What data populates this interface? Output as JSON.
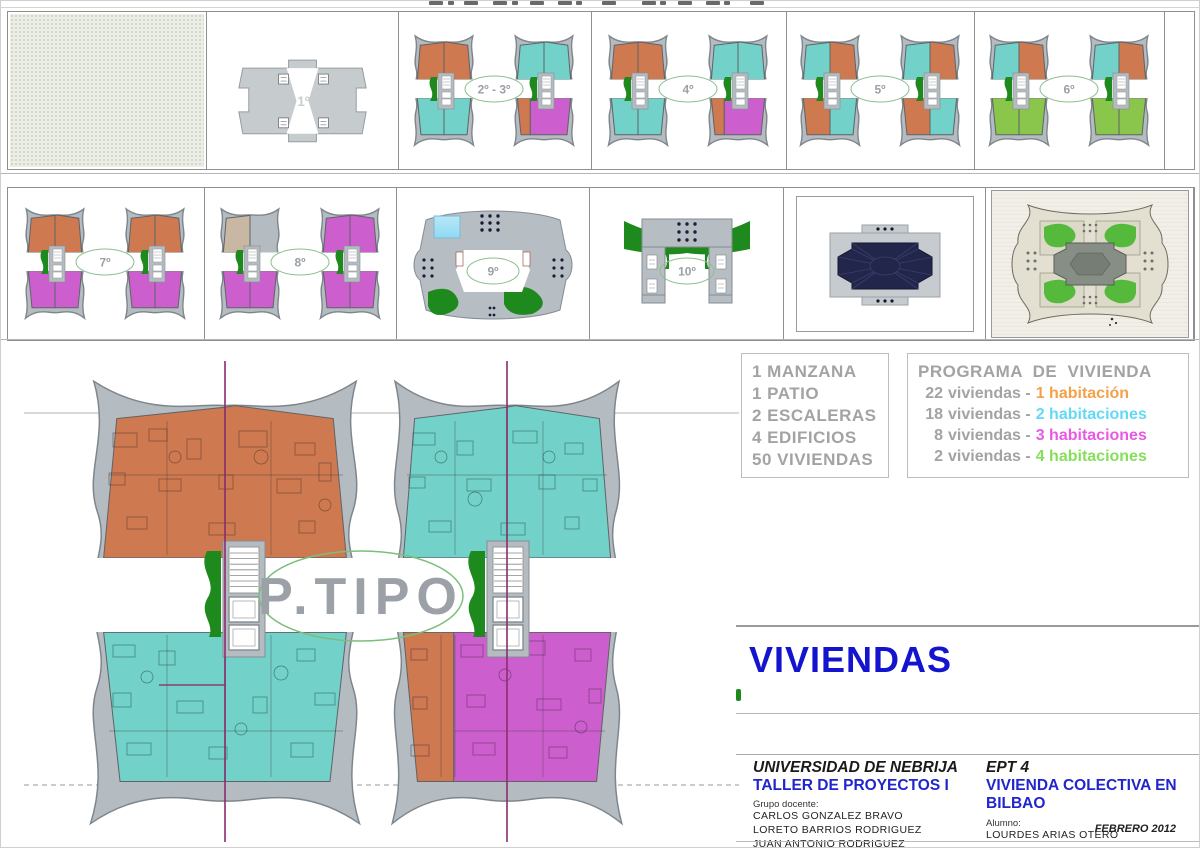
{
  "palette": {
    "orange": "#ce7950",
    "teal": "#72d1c8",
    "magenta": "#cd5ece",
    "green": "#8ac54c",
    "beige": "#c7b7a3",
    "none": "",
    "building": "#b5bcc1",
    "building_stroke": "#7e868c",
    "core_green": "#1e8a1e",
    "navy": "#23264b",
    "site_green": "#55ba3c",
    "label_text": "#9aa0a6",
    "label_ring": "#8cbf8c",
    "cut_line": "#8b2f6e",
    "pool_blue": "#8ed9f2"
  },
  "floors_row1": [
    {
      "id": "planta-baja",
      "label": "",
      "type": "ground"
    },
    {
      "id": "planta-1",
      "label": "1º",
      "type": "podium"
    },
    {
      "id": "planta-2-3",
      "label": "2º - 3º",
      "type": "pair",
      "towers": [
        {
          "tl": "orange",
          "tr": "orange",
          "bl": "teal",
          "br": "teal"
        },
        {
          "tl": "teal",
          "tr": "teal",
          "bl": "orange",
          "br": "magenta",
          "bl_narrow": true
        }
      ]
    },
    {
      "id": "planta-4",
      "label": "4º",
      "type": "pair",
      "towers": [
        {
          "tl": "orange",
          "tr": "orange",
          "bl": "teal",
          "br": "teal"
        },
        {
          "tl": "teal",
          "tr": "teal",
          "bl": "orange",
          "br": "magenta",
          "bl_narrow": true
        }
      ]
    },
    {
      "id": "planta-5",
      "label": "5º",
      "type": "pair",
      "towers": [
        {
          "tl": "teal",
          "tr": "orange",
          "bl": "orange",
          "br": "teal"
        },
        {
          "tl": "teal",
          "tr": "orange",
          "bl": "orange",
          "br": "teal"
        }
      ]
    },
    {
      "id": "planta-6",
      "label": "6º",
      "type": "pair",
      "towers": [
        {
          "tl": "teal",
          "tr": "orange",
          "bl": "green",
          "br": "green"
        },
        {
          "tl": "teal",
          "tr": "orange",
          "bl": "green",
          "br": "green"
        }
      ]
    }
  ],
  "floors_row2": [
    {
      "id": "planta-7",
      "label": "7º",
      "type": "pair",
      "towers": [
        {
          "tl": "orange",
          "tr": "orange",
          "bl": "magenta",
          "br": "magenta"
        },
        {
          "tl": "orange",
          "tr": "orange",
          "bl": "magenta",
          "br": "magenta"
        }
      ]
    },
    {
      "id": "planta-8",
      "label": "8º",
      "type": "pair",
      "towers": [
        {
          "tl": "beige",
          "tr": "none",
          "bl": "magenta",
          "br": "magenta"
        },
        {
          "tl": "magenta",
          "tr": "magenta",
          "bl": "magenta",
          "br": "magenta"
        }
      ]
    },
    {
      "id": "planta-9",
      "label": "9º",
      "type": "roof9"
    },
    {
      "id": "planta-10",
      "label": "10º",
      "type": "roof10"
    },
    {
      "id": "cubierta",
      "label": "",
      "type": "roof-dark"
    },
    {
      "id": "conjunto",
      "label": "",
      "type": "site"
    }
  ],
  "main_plan": {
    "label": "P.TIPO"
  },
  "summary": {
    "lines": [
      "1 MANZANA",
      "1 PATIO",
      "2 ESCALERAS",
      "4 EDIFICIOS",
      "50 VIVIENDAS"
    ]
  },
  "program": {
    "title": "PROGRAMA DE VIVIENDA",
    "rows": [
      {
        "count": "22",
        "middle": "viviendas -",
        "type": "1 habitación",
        "color": "#f5a04b"
      },
      {
        "count": "18",
        "middle": "viviendas -",
        "type": "2 habitaciones",
        "color": "#62d9f7"
      },
      {
        "count": "8",
        "middle": "viviendas -",
        "type": "3 habitaciones",
        "color": "#e959e3"
      },
      {
        "count": "2",
        "middle": "viviendas -",
        "type": "4 habitaciones",
        "color": "#86df5a"
      }
    ]
  },
  "section_title": "VIVIENDAS",
  "titleblock": {
    "university": "UNIVERSIDAD DE NEBRIJA",
    "course": "TALLER DE PROYECTOS I",
    "group_label": "Grupo docente:",
    "teachers": [
      "CARLOS  GONZALEZ  BRAVO",
      "LORETO  BARRIOS  RODRIGUEZ",
      "JUAN ANTONIO  RODRIGUEZ  FERNANDEZ"
    ],
    "course_code": "EPT 4",
    "project": "VIVIENDA COLECTIVA EN BILBAO",
    "student_label": "Alumno:",
    "student": "LOURDES  ARIAS  OTERO",
    "date": "FEBRERO 2012"
  }
}
